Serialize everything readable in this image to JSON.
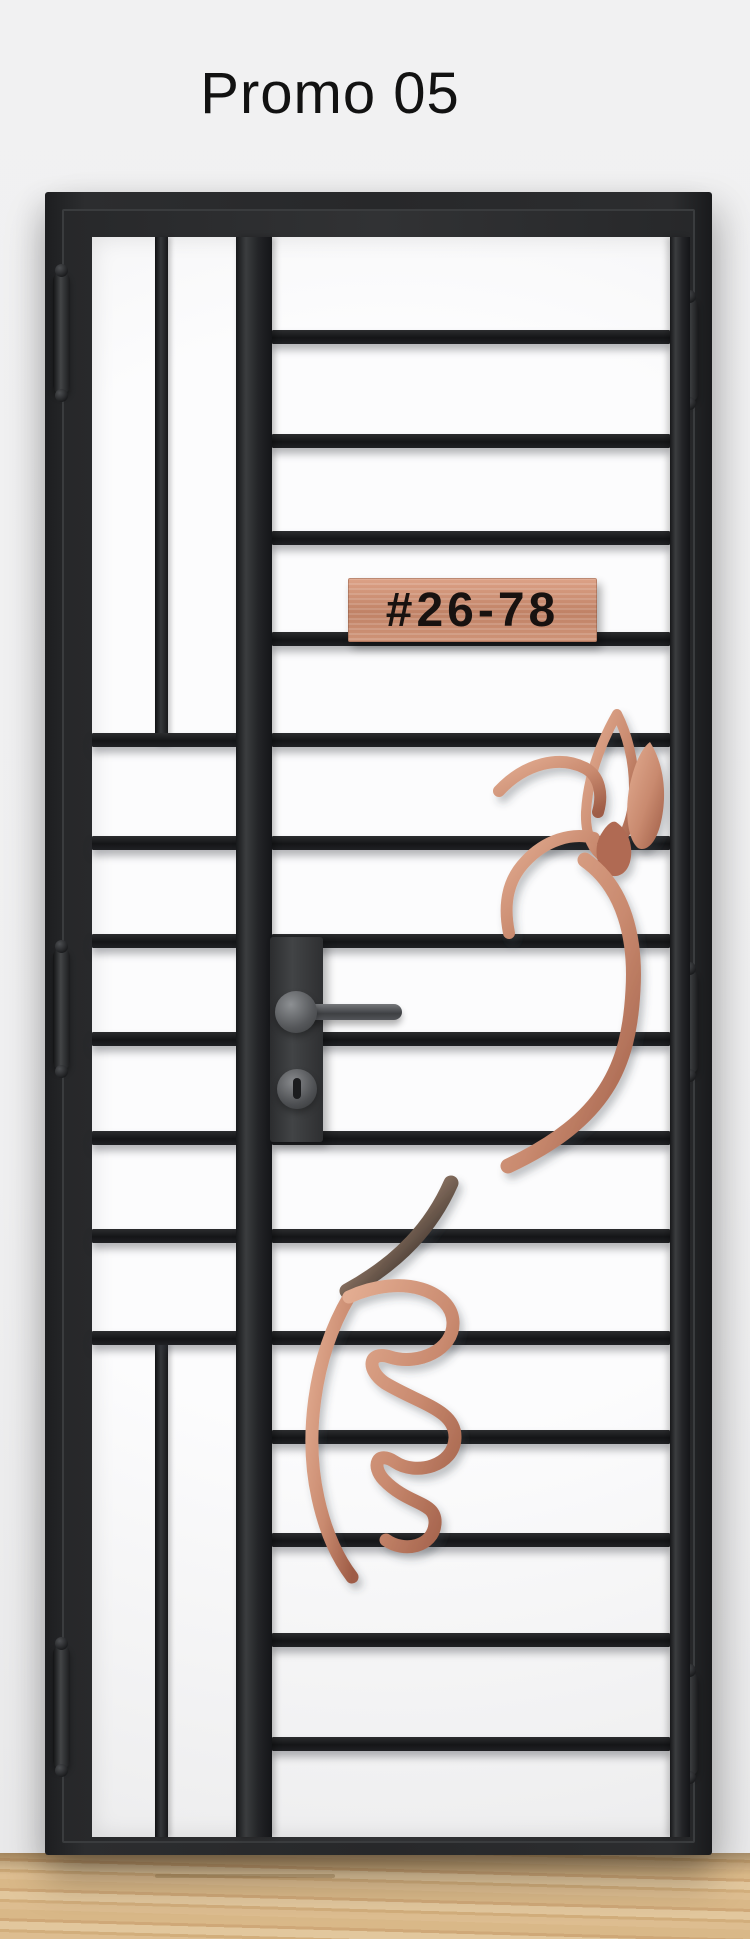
{
  "page": {
    "title": "Promo 05",
    "wall_color": "#f0f0f1"
  },
  "door": {
    "unit_plate": {
      "text": "#26-78",
      "material_color": "#cf9178"
    },
    "frame_color": "#27282a",
    "bar_color": "#1a1b1d",
    "ornament_copper_color": "#c98a6f",
    "hardware": {
      "handle": "lever-handle",
      "lock": "keyhole-cylinder",
      "hinge_count": 6
    }
  },
  "floor": {
    "material": "light-wood",
    "color": "#d6b384"
  }
}
